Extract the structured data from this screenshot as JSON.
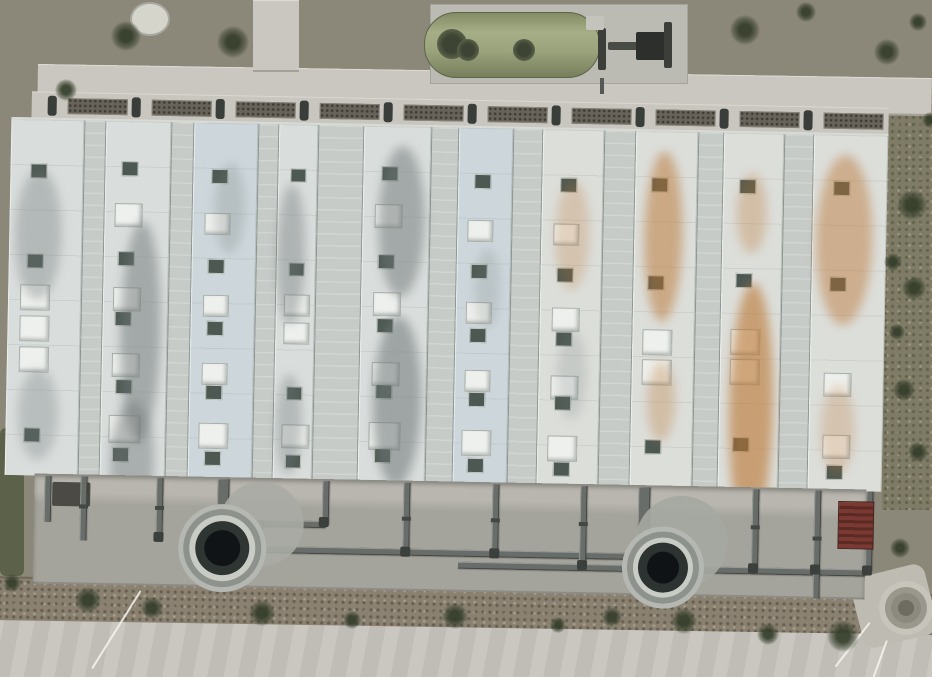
{
  "meta": {
    "description": "Aerial drone photo of industrial water-treatment facility",
    "width": 932,
    "height": 677
  },
  "palette": {
    "gravel": "#8b8779",
    "concrete_path": "#c9c7bf",
    "road": "#c6c4bc",
    "dirt": "#8a8171",
    "grass": "#7f7b66",
    "roof_green": "#527e6a",
    "roof_white": "#d9dddc",
    "roof_blue_white": "#cdd7db",
    "roof_warm_white": "#dcdeda",
    "pipe_gray": "#686d69",
    "tank_dark": "#101417",
    "green_vessel": "#9ba37c",
    "stairs_maroon": "#6e332d",
    "stain_gray": "110,118,118",
    "stain_rust": "186,116,48"
  },
  "building": {
    "origin": {
      "x": 12,
      "y": 91
    },
    "width": 880,
    "height": 492,
    "rotation_deg": 1.1,
    "walkway": {
      "x": 20,
      "w": 857,
      "h": 26,
      "pocket_count": 10,
      "pocket_start": 56,
      "pocket_step": 84,
      "pocket_w": 60,
      "stub_start": 36
    },
    "roof": {
      "y": 26,
      "h": 356,
      "w": 877,
      "base": "#c7cbc8"
    },
    "apron": {
      "x": 30,
      "y": 382,
      "w": 832,
      "h": 110,
      "top": "#b8b6ae",
      "body": "#a5a49c"
    },
    "stripes": [
      {
        "x": 0,
        "w": 73,
        "type": "white",
        "tint": "#d9dddc"
      },
      {
        "x": 73,
        "w": 22,
        "type": "green"
      },
      {
        "x": 95,
        "w": 65,
        "type": "white",
        "tint": "#d9dddc"
      },
      {
        "x": 160,
        "w": 23,
        "type": "green"
      },
      {
        "x": 183,
        "w": 64,
        "type": "white",
        "tint": "#cdd7db"
      },
      {
        "x": 247,
        "w": 21,
        "type": "green"
      },
      {
        "x": 268,
        "w": 39,
        "type": "white",
        "tint": "#d9dddc"
      },
      {
        "x": 307,
        "w": 46,
        "type": "green"
      },
      {
        "x": 353,
        "w": 67,
        "type": "white",
        "tint": "#d9dddc"
      },
      {
        "x": 420,
        "w": 28,
        "type": "green"
      },
      {
        "x": 448,
        "w": 54,
        "type": "white",
        "tint": "#cdd7db"
      },
      {
        "x": 502,
        "w": 30,
        "type": "green"
      },
      {
        "x": 532,
        "w": 61,
        "type": "white",
        "tint": "#dcdeda"
      },
      {
        "x": 593,
        "w": 32,
        "type": "green"
      },
      {
        "x": 625,
        "w": 62,
        "type": "white",
        "tint": "#dcdeda"
      },
      {
        "x": 687,
        "w": 26,
        "type": "green"
      },
      {
        "x": 713,
        "w": 60,
        "type": "white",
        "tint": "#dcdeda"
      },
      {
        "x": 773,
        "w": 30,
        "type": "green"
      },
      {
        "x": 803,
        "w": 74,
        "type": "white",
        "tint": "#dcdeda"
      }
    ],
    "squares": [
      [
        0,
        20,
        44,
        "d",
        15
      ],
      [
        0,
        18,
        134,
        "d",
        15
      ],
      [
        0,
        12,
        165,
        "l",
        28
      ],
      [
        0,
        12,
        196,
        "l",
        28
      ],
      [
        0,
        12,
        227,
        "l",
        28
      ],
      [
        0,
        18,
        308,
        "d",
        15
      ],
      [
        2,
        16,
        40,
        "d",
        15
      ],
      [
        2,
        10,
        82,
        "l",
        26
      ],
      [
        2,
        14,
        130,
        "d",
        15
      ],
      [
        2,
        10,
        166,
        "l",
        26
      ],
      [
        2,
        12,
        190,
        "d",
        15
      ],
      [
        2,
        10,
        232,
        "l",
        26
      ],
      [
        2,
        14,
        258,
        "d",
        15
      ],
      [
        2,
        8,
        294,
        "l",
        30
      ],
      [
        2,
        12,
        326,
        "d",
        15
      ],
      [
        4,
        18,
        46,
        "d",
        15
      ],
      [
        4,
        12,
        90,
        "l",
        24
      ],
      [
        4,
        16,
        136,
        "d",
        15
      ],
      [
        4,
        12,
        172,
        "l",
        24
      ],
      [
        4,
        16,
        198,
        "d",
        15
      ],
      [
        4,
        12,
        240,
        "l",
        24
      ],
      [
        4,
        16,
        262,
        "d",
        15
      ],
      [
        4,
        10,
        300,
        "l",
        28
      ],
      [
        4,
        16,
        328,
        "d",
        15
      ],
      [
        6,
        12,
        44,
        "d",
        14
      ],
      [
        6,
        12,
        138,
        "d",
        14
      ],
      [
        6,
        8,
        170,
        "l",
        24
      ],
      [
        6,
        8,
        198,
        "l",
        24
      ],
      [
        6,
        12,
        262,
        "d",
        14
      ],
      [
        6,
        8,
        300,
        "l",
        26
      ],
      [
        6,
        12,
        330,
        "d",
        14
      ],
      [
        8,
        18,
        40,
        "d",
        15
      ],
      [
        8,
        12,
        78,
        "l",
        26
      ],
      [
        8,
        16,
        128,
        "d",
        15
      ],
      [
        8,
        12,
        166,
        "l",
        26
      ],
      [
        8,
        16,
        192,
        "d",
        15
      ],
      [
        8,
        12,
        236,
        "l",
        26
      ],
      [
        8,
        16,
        258,
        "d",
        15
      ],
      [
        8,
        10,
        296,
        "l",
        30
      ],
      [
        8,
        16,
        322,
        "d",
        15
      ],
      [
        10,
        16,
        46,
        "d",
        15
      ],
      [
        10,
        10,
        92,
        "l",
        24
      ],
      [
        10,
        14,
        136,
        "d",
        15
      ],
      [
        10,
        10,
        174,
        "l",
        24
      ],
      [
        10,
        14,
        200,
        "d",
        15
      ],
      [
        10,
        10,
        242,
        "l",
        24
      ],
      [
        10,
        14,
        264,
        "d",
        15
      ],
      [
        10,
        8,
        302,
        "l",
        28
      ],
      [
        10,
        14,
        330,
        "d",
        15
      ],
      [
        12,
        18,
        48,
        "d",
        15
      ],
      [
        12,
        12,
        94,
        "l",
        24
      ],
      [
        12,
        16,
        138,
        "d",
        15
      ],
      [
        12,
        12,
        178,
        "l",
        26
      ],
      [
        12,
        16,
        202,
        "d",
        15
      ],
      [
        12,
        12,
        246,
        "l",
        26
      ],
      [
        12,
        16,
        266,
        "d",
        15
      ],
      [
        12,
        10,
        306,
        "l",
        28
      ],
      [
        12,
        16,
        332,
        "d",
        15
      ],
      [
        14,
        16,
        46,
        "d",
        15
      ],
      [
        14,
        14,
        144,
        "d",
        15
      ],
      [
        14,
        10,
        198,
        "l",
        28
      ],
      [
        14,
        10,
        228,
        "l",
        28
      ],
      [
        14,
        14,
        308,
        "d",
        15
      ],
      [
        16,
        16,
        46,
        "d",
        15
      ],
      [
        16,
        14,
        140,
        "d",
        15
      ],
      [
        16,
        10,
        196,
        "l",
        28
      ],
      [
        16,
        10,
        226,
        "l",
        28
      ],
      [
        16,
        14,
        304,
        "d",
        15
      ],
      [
        18,
        20,
        46,
        "d",
        15
      ],
      [
        18,
        18,
        142,
        "d",
        15
      ],
      [
        18,
        14,
        238,
        "l",
        26
      ],
      [
        18,
        14,
        300,
        "l",
        26
      ],
      [
        18,
        18,
        330,
        "d",
        15
      ]
    ],
    "stains": [
      [
        0,
        14,
        50,
        46,
        130,
        "gray",
        0.35
      ],
      [
        0,
        20,
        250,
        40,
        90,
        "gray",
        0.3
      ],
      [
        2,
        26,
        100,
        40,
        220,
        "gray",
        0.5
      ],
      [
        2,
        18,
        280,
        44,
        120,
        "gray",
        0.45
      ],
      [
        4,
        30,
        40,
        30,
        90,
        "gray",
        0.25
      ],
      [
        6,
        8,
        60,
        28,
        140,
        "gray",
        0.4
      ],
      [
        6,
        10,
        250,
        26,
        100,
        "gray",
        0.35
      ],
      [
        8,
        24,
        20,
        46,
        150,
        "gray",
        0.5
      ],
      [
        8,
        22,
        190,
        48,
        170,
        "gray",
        0.55
      ],
      [
        10,
        26,
        120,
        26,
        80,
        "gray",
        0.2
      ],
      [
        12,
        22,
        50,
        34,
        110,
        "rust",
        0.25
      ],
      [
        12,
        26,
        200,
        30,
        90,
        "gray",
        0.2
      ],
      [
        14,
        18,
        20,
        38,
        170,
        "rust",
        0.5
      ],
      [
        14,
        24,
        230,
        28,
        80,
        "rust",
        0.3
      ],
      [
        16,
        18,
        150,
        44,
        250,
        "rust",
        0.6
      ],
      [
        16,
        22,
        40,
        30,
        80,
        "rust",
        0.3
      ],
      [
        18,
        12,
        20,
        56,
        170,
        "rust",
        0.45
      ],
      [
        18,
        20,
        250,
        34,
        90,
        "rust",
        0.25
      ]
    ],
    "pipes": {
      "verticals": [
        [
          40,
          384,
          46,
          7
        ],
        [
          76,
          384,
          64,
          7
        ],
        [
          152,
          384,
          58,
          7
        ],
        [
          213,
          384,
          46,
          12
        ],
        [
          252,
          424,
          28,
          7
        ],
        [
          318,
          384,
          44,
          7
        ],
        [
          399,
          384,
          70,
          7
        ],
        [
          488,
          384,
          70,
          7
        ],
        [
          576,
          384,
          80,
          7
        ],
        [
          634,
          384,
          60,
          12
        ],
        [
          748,
          384,
          80,
          7
        ],
        [
          810,
          384,
          108,
          7
        ],
        [
          862,
          384,
          80,
          7
        ]
      ],
      "mains": [
        [
          252,
          450,
          380,
          7
        ],
        [
          455,
          462,
          407,
          7
        ],
        [
          254,
          424,
          68,
          7
        ]
      ],
      "collars": [
        [
          399,
          418
        ],
        [
          488,
          418
        ],
        [
          576,
          420
        ],
        [
          748,
          420
        ],
        [
          810,
          430
        ],
        [
          152,
          412
        ],
        [
          76,
          412
        ]
      ],
      "nodes": [
        [
          315,
          420
        ],
        [
          397,
          448
        ],
        [
          486,
          448
        ],
        [
          574,
          458
        ],
        [
          745,
          458
        ],
        [
          807,
          458
        ],
        [
          859,
          458
        ],
        [
          150,
          438
        ],
        [
          250,
          446
        ],
        [
          632,
          436
        ],
        [
          211,
          424
        ]
      ],
      "recess": [
        48,
        390,
        38,
        24
      ]
    },
    "tanks": [
      {
        "cx": 219,
        "cy": 453,
        "dome": {
          "dx": 39,
          "dy": -25,
          "r": 42,
          "c": "#a8aba4"
        },
        "rings": [
          [
            44,
            "#b5b8b2"
          ],
          [
            39,
            "#8e928c"
          ],
          [
            33,
            "#c9cbc5"
          ],
          [
            27,
            "#2f3532"
          ],
          [
            18,
            "#101417"
          ]
        ]
      },
      {
        "cx": 660,
        "cy": 464,
        "dome": {
          "dx": 18,
          "dy": -26,
          "r": 46,
          "c": "#a5a8a1"
        },
        "rings": [
          [
            41,
            "#b5b8b2"
          ],
          [
            36,
            "#8e928c"
          ],
          [
            30,
            "#c9cbc5"
          ],
          [
            25,
            "#2d3330"
          ],
          [
            16,
            "#0f1316"
          ]
        ]
      }
    ],
    "stairs": {
      "x": 834,
      "y": 394,
      "w": 34,
      "h": 46
    }
  },
  "top_area": {
    "path_h": {
      "x": 38,
      "y": 64,
      "w": 894,
      "h": 38,
      "rot": 0.9
    },
    "path_v": {
      "x": 253,
      "y": 0,
      "w": 46,
      "h": 72
    },
    "manhole": {
      "x": 130,
      "y": 2,
      "w": 36,
      "h": 30
    },
    "vessel_pad": {
      "x": 430,
      "y": 4,
      "w": 258,
      "h": 80
    },
    "green_vessel": {
      "x": 424,
      "y": 12,
      "w": 174,
      "h": 64
    },
    "fans": [
      [
        452,
        28,
        30
      ],
      [
        468,
        34,
        22
      ],
      [
        524,
        34,
        22
      ]
    ],
    "equipment": [
      [
        598,
        28,
        8,
        42,
        "#3b3e39"
      ],
      [
        608,
        42,
        58,
        8,
        "#494c46"
      ],
      [
        636,
        32,
        32,
        28,
        "#2c2f2b"
      ],
      [
        664,
        22,
        8,
        46,
        "#3b3e39"
      ],
      [
        586,
        16,
        18,
        14,
        "#c4c4bc"
      ]
    ],
    "stub_pipe": [
      600,
      78,
      4,
      16
    ]
  },
  "ground": {
    "grass_strip": {
      "x": 882,
      "y": 86,
      "w": 50,
      "h": 424
    },
    "grass_patch": {
      "x": 0,
      "y": 428,
      "w": 24,
      "h": 148
    },
    "dirt_band": {
      "x": -10,
      "y": 576,
      "w": 960,
      "h": 72,
      "rot": 1.1
    },
    "road": {
      "x": -10,
      "y": 620,
      "w": 960,
      "h": 70,
      "rot": 0.9
    },
    "pad_br": {
      "x": 856,
      "y": 570,
      "w": 76,
      "h": 72,
      "rot": -14
    },
    "circle_br": {
      "cx": 906,
      "cy": 608,
      "rings": [
        [
          27,
          "#c6c4bb"
        ],
        [
          21,
          "#9a988c"
        ],
        [
          15,
          "#8c8a7e"
        ],
        [
          8,
          "#6e6c61"
        ]
      ]
    },
    "thin_lines": [
      {
        "x": 140,
        "y": 590,
        "len": 92,
        "ang": 32
      },
      {
        "x": 869,
        "y": 622,
        "len": 56,
        "ang": 38
      },
      {
        "x": 886,
        "y": 640,
        "len": 40,
        "ang": 20
      }
    ],
    "shrubs": [
      [
        126,
        36,
        30
      ],
      [
        233,
        42,
        32
      ],
      [
        66,
        90,
        22
      ],
      [
        745,
        30,
        30
      ],
      [
        806,
        12,
        20
      ],
      [
        887,
        52,
        26
      ],
      [
        918,
        22,
        18
      ],
      [
        912,
        205,
        30
      ],
      [
        893,
        262,
        18
      ],
      [
        914,
        288,
        24
      ],
      [
        904,
        390,
        22
      ],
      [
        918,
        452,
        20
      ],
      [
        897,
        332,
        16
      ],
      [
        900,
        548,
        20
      ],
      [
        88,
        600,
        26
      ],
      [
        152,
        608,
        22
      ],
      [
        262,
        613,
        26
      ],
      [
        352,
        620,
        18
      ],
      [
        455,
        616,
        26
      ],
      [
        558,
        625,
        16
      ],
      [
        612,
        617,
        20
      ],
      [
        684,
        621,
        26
      ],
      [
        768,
        634,
        22
      ],
      [
        843,
        636,
        32
      ],
      [
        12,
        583,
        18
      ],
      [
        930,
        120,
        16
      ]
    ]
  }
}
